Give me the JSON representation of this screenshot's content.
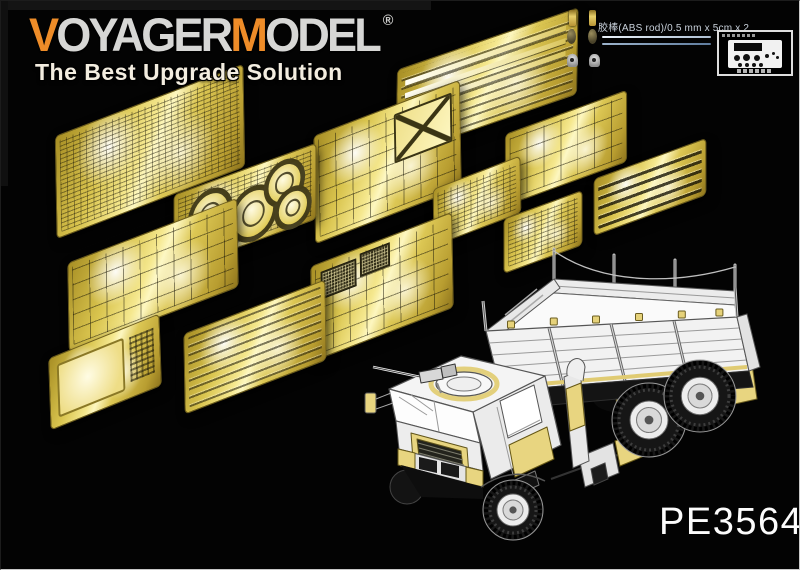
{
  "colors": {
    "background": "#030303",
    "logo_orange": "#ee8c28",
    "logo_silver": "#d7d7d5",
    "tagline_white": "#f3ede0",
    "brass_sheet": "#e3cf5e",
    "brass_highlight": "#fdf7c0",
    "product_code_white": "#fcfcfc"
  },
  "logo": {
    "v": "V",
    "oyager": "OYAGER",
    "m": "M",
    "odel": "ODEL",
    "registered": "®",
    "tagline": "The Best Upgrade Solution"
  },
  "extras": {
    "abs_rod_label": "胶棒(ABS rod)/0.5 mm x 5cm x 2"
  },
  "product_code": "PE35648",
  "pe_sheets": [
    "fret-top-long-strips",
    "fret-left-dense-parts",
    "fret-x-brace-plates",
    "fret-right-plates",
    "fret-round-discs",
    "fret-dash-panel",
    "fret-leaf-strips",
    "fret-left-square-plates",
    "fret-mesh-grids",
    "fret-rail-strips",
    "fret-blank-plate",
    "fret-small-plates"
  ]
}
